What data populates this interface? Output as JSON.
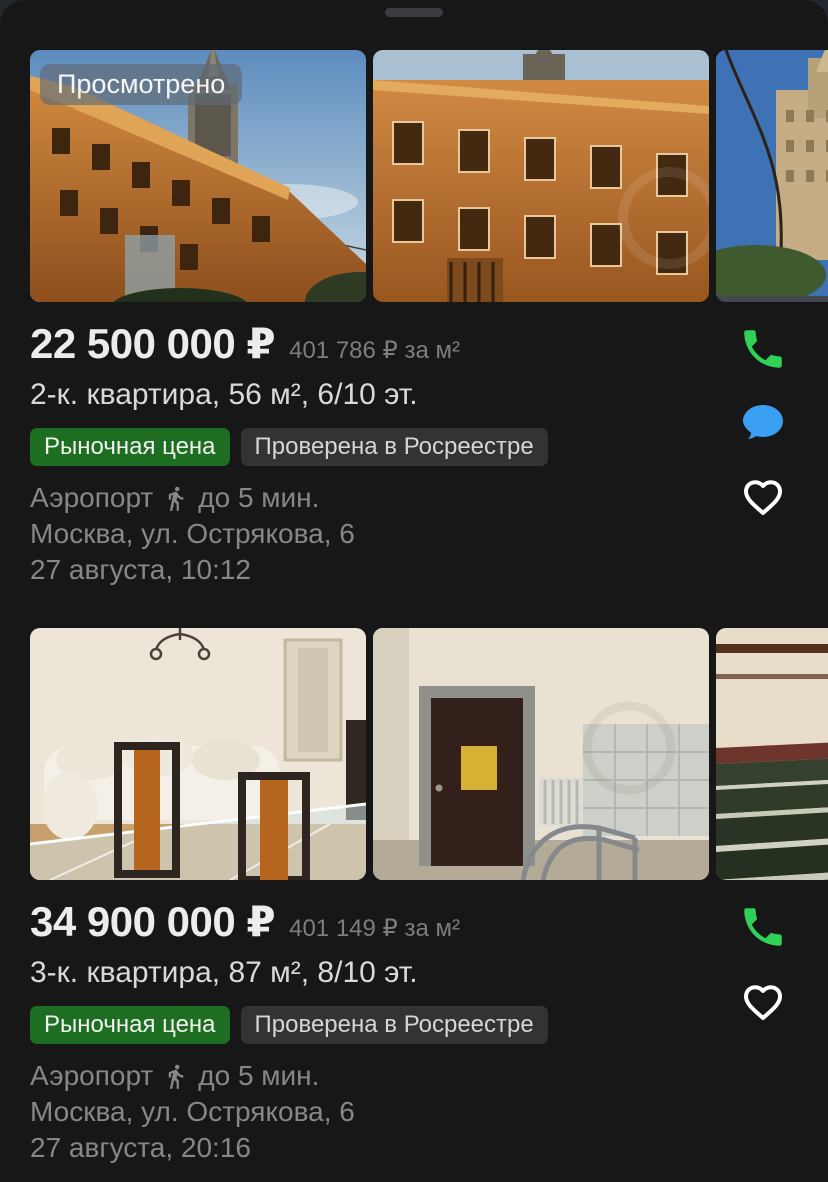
{
  "sheet": {
    "viewed_badge": "Просмотрено"
  },
  "colors": {
    "sheet_bg": "#171717",
    "badge_green": "#1d6e20",
    "badge_gray": "#333335",
    "phone_green": "#30d158",
    "chat_blue": "#3b9ff3",
    "heart_white": "#ffffff",
    "muted_text": "#878787"
  },
  "listings": [
    {
      "viewed_badge": "Просмотрено",
      "price": "22 500 000 ₽",
      "price_per_unit": "401 786 ₽ за м²",
      "title": "2-к. квартира, 56 м², 6/10 эт.",
      "badges": [
        {
          "label": "Рыночная цена",
          "style": "green"
        },
        {
          "label": "Проверена в Росреестре",
          "style": "gray"
        }
      ],
      "metro_station": "Аэропорт",
      "walk_time": "до 5 мин.",
      "address": "Москва, ул. Острякова, 6",
      "posted": "27 августа, 10:12",
      "photos": [
        "building-exterior-with-tower",
        "building-facade-closeup",
        "street-view-parking-sign"
      ],
      "actions": [
        "call",
        "chat",
        "favorite"
      ]
    },
    {
      "price": "34 900 000 ₽",
      "price_per_unit": "401 149 ₽ за м²",
      "title": "3-к. квартира, 87 м², 8/10 эт.",
      "badges": [
        {
          "label": "Рыночная цена",
          "style": "green"
        },
        {
          "label": "Проверена в Росреестре",
          "style": "gray"
        }
      ],
      "metro_station": "Аэропорт",
      "walk_time": "до 5 мин.",
      "address": "Москва, ул. Острякова, 6",
      "posted": "27 августа, 20:16",
      "photos": [
        "living-room-dining-table",
        "entrance-hall-ramp",
        "staircase"
      ],
      "actions": [
        "call",
        "favorite"
      ]
    }
  ]
}
